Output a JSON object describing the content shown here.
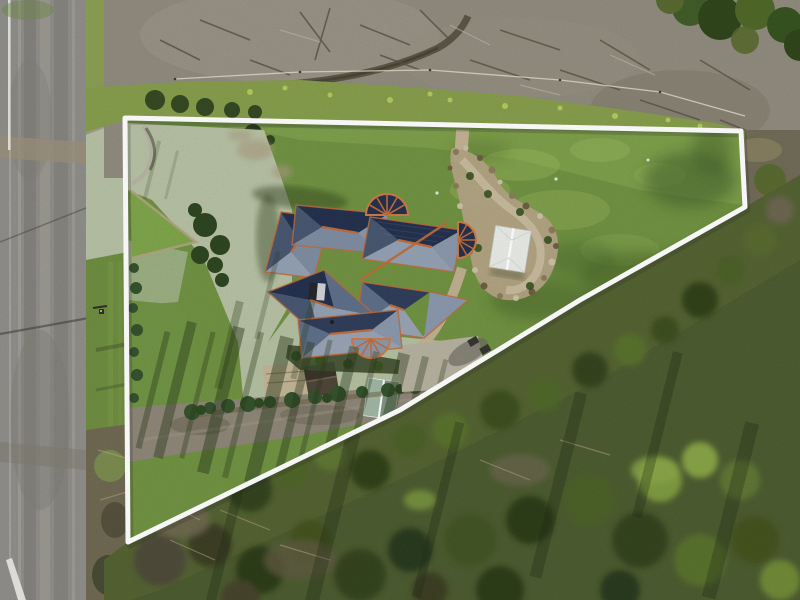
{
  "meta": {
    "type": "aerial-drone-photograph",
    "subject": "residential property with marked lot boundary overlay",
    "view": "top-down"
  },
  "boundary": {
    "points_svg": "125,118 741,131 745,207 580,300 400,410 128,542",
    "stroke_width": 5,
    "color": "#ffffff"
  },
  "palette": {
    "asphalt": "#8e8d89",
    "asphalt_dark": "#75746d",
    "shoulder": "#a9a69c",
    "line_white": "#e9e9e4",
    "gravel": "#8f8a7d",
    "gravel_light": "#a19b8d",
    "weeds": "#859c4a",
    "weeds_bright": "#b8cd60",
    "verge_green": "#6d8c3f",
    "lawn_mid": "#6f9140",
    "lawn_bright": "#8aab52",
    "lawn_shadow": "#3f5c26",
    "court": "#b6c0a3",
    "court_green": "#a8b895",
    "roof_navy": "#222f4d",
    "roof_mid": "#5d6e88",
    "roof_light": "#93a0b3",
    "ridge_orange": "#c06a38",
    "paving": "#b5b09e",
    "path_tan": "#c2b193",
    "rock_tan": "#b3a384",
    "shrub_dark": "#2c441f",
    "hedge_green": "#31512a",
    "gazebo_white": "#e9ebe7",
    "shed_green": "#9fb6a3",
    "shed_dark": "#4e4337",
    "scrub_base": "#4a5a2e",
    "scrub_shadow": "#243318",
    "scrub_brown": "#6e6750",
    "scrub_bright": "#86a344"
  },
  "scene": {
    "regions": [
      "road",
      "road-shoulder",
      "grass-verge",
      "cleared-gravel-area",
      "weed-band",
      "property-lawn",
      "old-court-surface",
      "house-roof",
      "rock-garden",
      "gazebo",
      "driveway",
      "garden-sheds",
      "hedge-row",
      "bushland",
      "boundary-overlay",
      "power-pole"
    ]
  }
}
